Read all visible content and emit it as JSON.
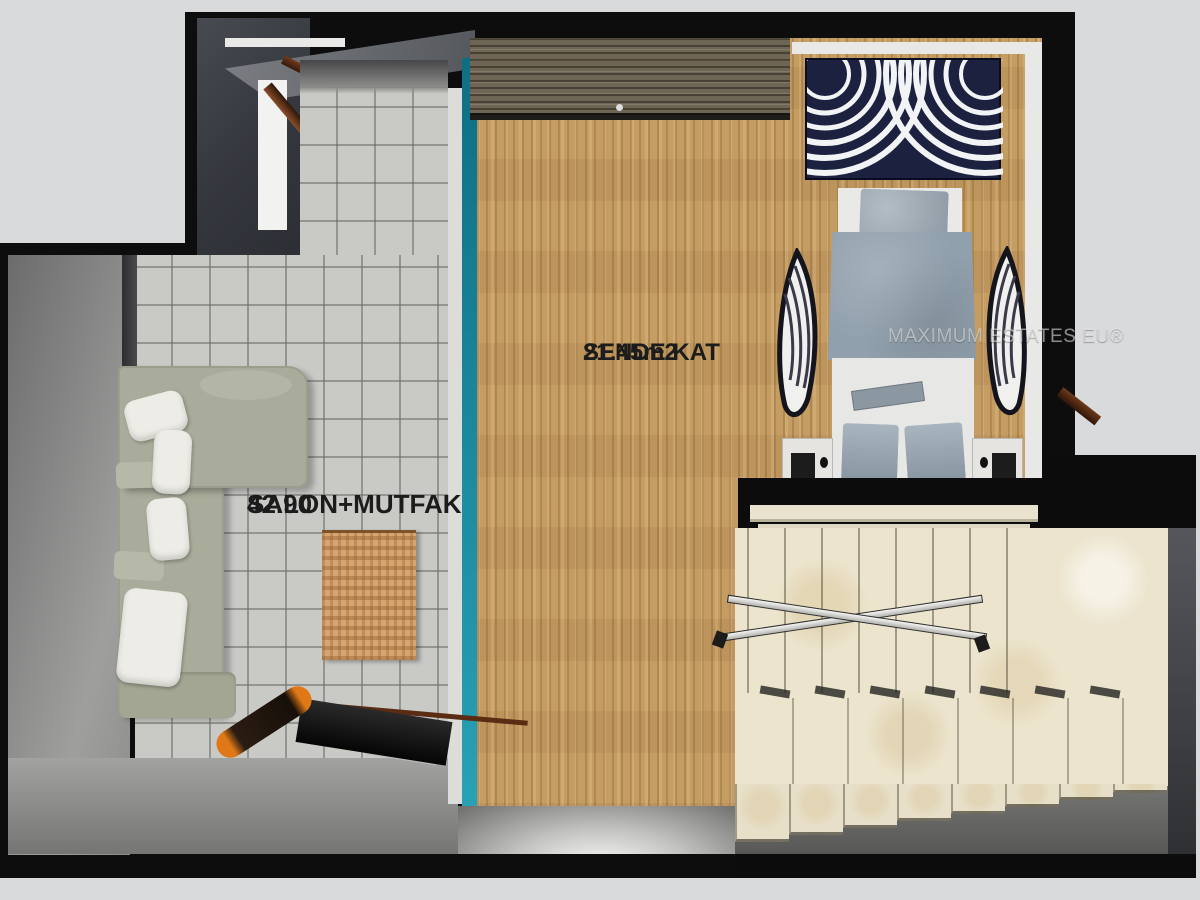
{
  "meta": {
    "type": "3d-floor-plan",
    "view": "top-down dollhouse render"
  },
  "labels": {
    "room_main": {
      "name": "SALON+MUTFAK",
      "area": "42.90"
    },
    "room_loft": {
      "name": "SENDE KAT",
      "area": "21.45m2"
    },
    "watermark": "MAXIMUM ESTATES EU®"
  },
  "staircase": {
    "upper_treads": 8,
    "lower_slabs": 7,
    "bottom_steps": 8
  },
  "furniture_icons": [
    "corner-sofa",
    "sofa-cushion",
    "area-rug",
    "tv-unit",
    "bolster-roll",
    "entrance-door",
    "balcony-door",
    "wardrobe",
    "headboard-art-panel",
    "double-bed",
    "bed-pillow",
    "duvet",
    "nightstand-left",
    "nightstand-right",
    "accent-chair-left",
    "accent-chair-right",
    "staircase",
    "handrail"
  ],
  "colors": {
    "background": "#d9dadc",
    "wall_black": "#0d0d0d",
    "entrance_charcoal": "#34373d",
    "tile_floor": "#c9c9c6",
    "wood_floor": "#c59c62",
    "teal_accent_wall": "#1b8296",
    "stairs_marble": "#ece4cd",
    "sofa_sage": "#a9ac9a",
    "cushion_white": "#edece6",
    "duvet_grey": "#90a0ac",
    "art_panel_navy": "#1c2140",
    "rug_tan": "#cf9e69",
    "terrace_grey": "#8d8d8d",
    "bolster_orange": "#e07818"
  }
}
